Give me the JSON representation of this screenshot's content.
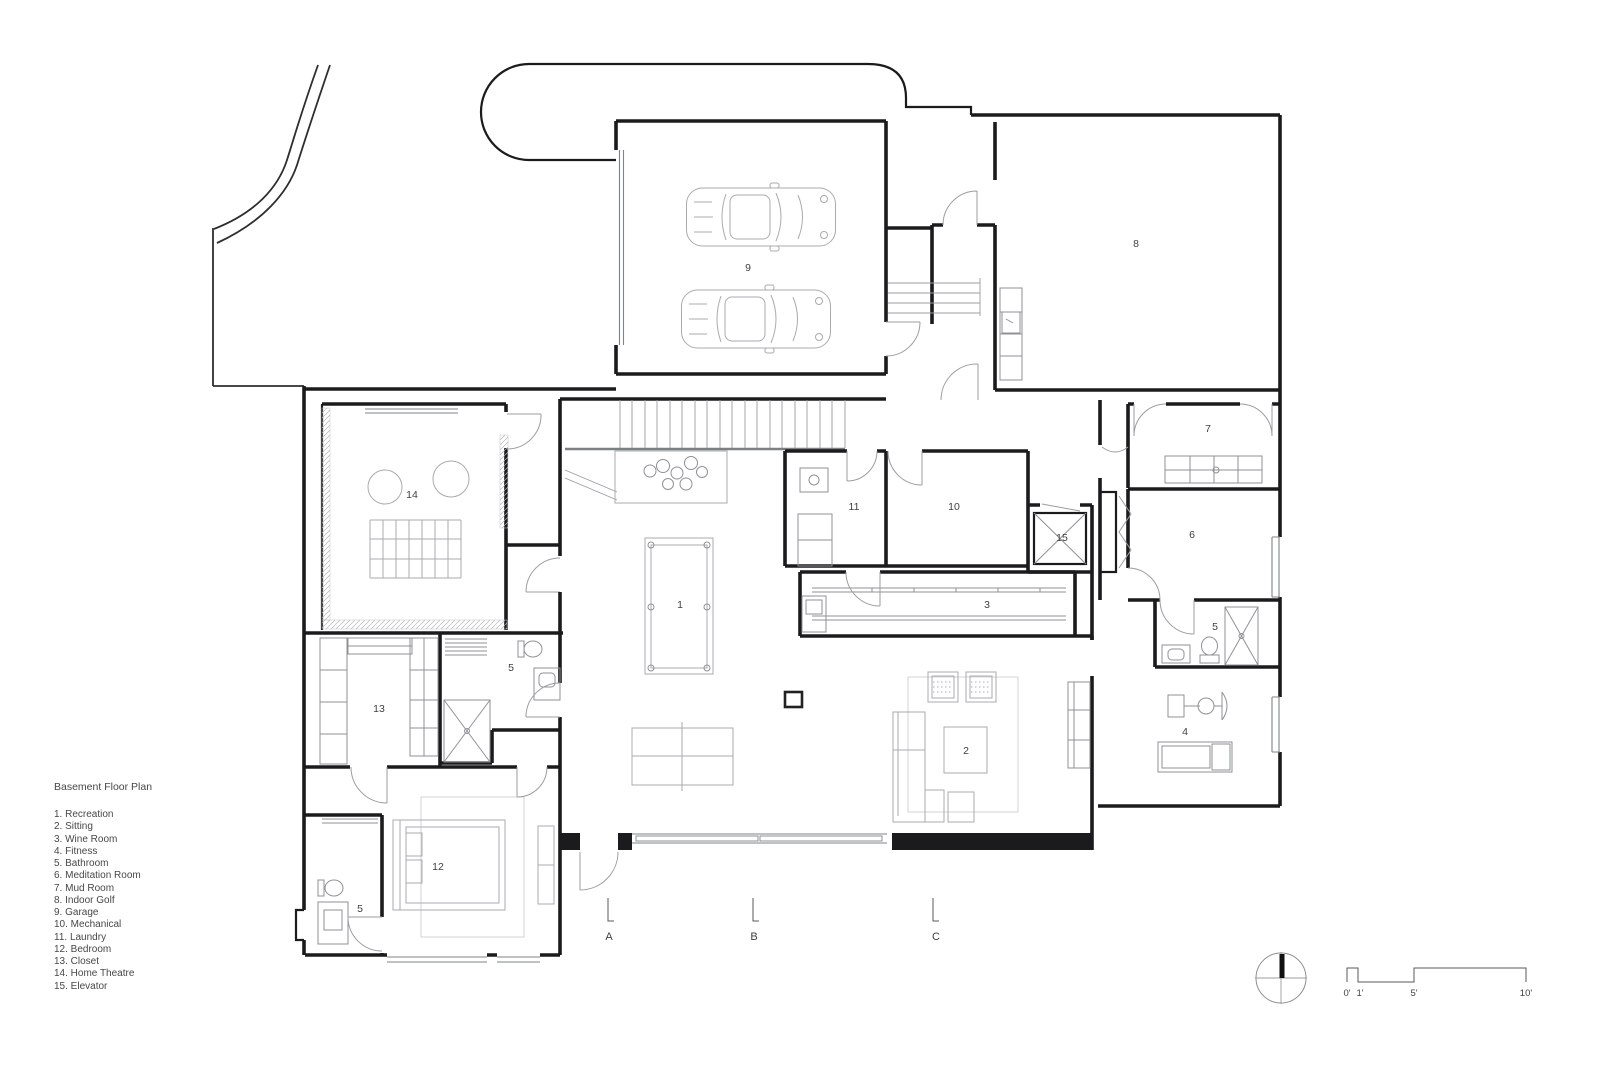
{
  "legend": {
    "title": "Basement Floor Plan",
    "items": [
      "1. Recreation",
      "2. Sitting",
      "3. Wine Room",
      "4. Fitness",
      "5. Bathroom",
      "6. Meditation Room",
      "7. Mud Room",
      "8. Indoor Golf",
      "9. Garage",
      "10. Mechanical",
      "11. Laundry",
      "12. Bedroom",
      "13. Closet",
      "14. Home Theatre",
      "15. Elevator"
    ]
  },
  "plan": {
    "room_labels": [
      {
        "number": "9",
        "room": "Garage"
      },
      {
        "number": "8",
        "room": "Indoor Golf"
      },
      {
        "number": "14",
        "room": "Home Theatre"
      },
      {
        "number": "7",
        "room": "Mud Room"
      },
      {
        "number": "11",
        "room": "Laundry"
      },
      {
        "number": "10",
        "room": "Mechanical"
      },
      {
        "number": "15",
        "room": "Elevator"
      },
      {
        "number": "6",
        "room": "Meditation Room"
      },
      {
        "number": "1",
        "room": "Recreation"
      },
      {
        "number": "3",
        "room": "Wine Room"
      },
      {
        "number": "5",
        "room": "Bathroom"
      },
      {
        "number": "5",
        "room": "Bathroom"
      },
      {
        "number": "13",
        "room": "Closet"
      },
      {
        "number": "4",
        "room": "Fitness"
      },
      {
        "number": "2",
        "room": "Sitting"
      },
      {
        "number": "12",
        "room": "Bedroom"
      },
      {
        "number": "5",
        "room": "Bathroom"
      }
    ]
  },
  "grid": {
    "columns": [
      "A",
      "B",
      "C"
    ]
  },
  "scale_bar": {
    "marks": [
      "0'",
      "1'",
      "5'",
      "10'"
    ]
  }
}
